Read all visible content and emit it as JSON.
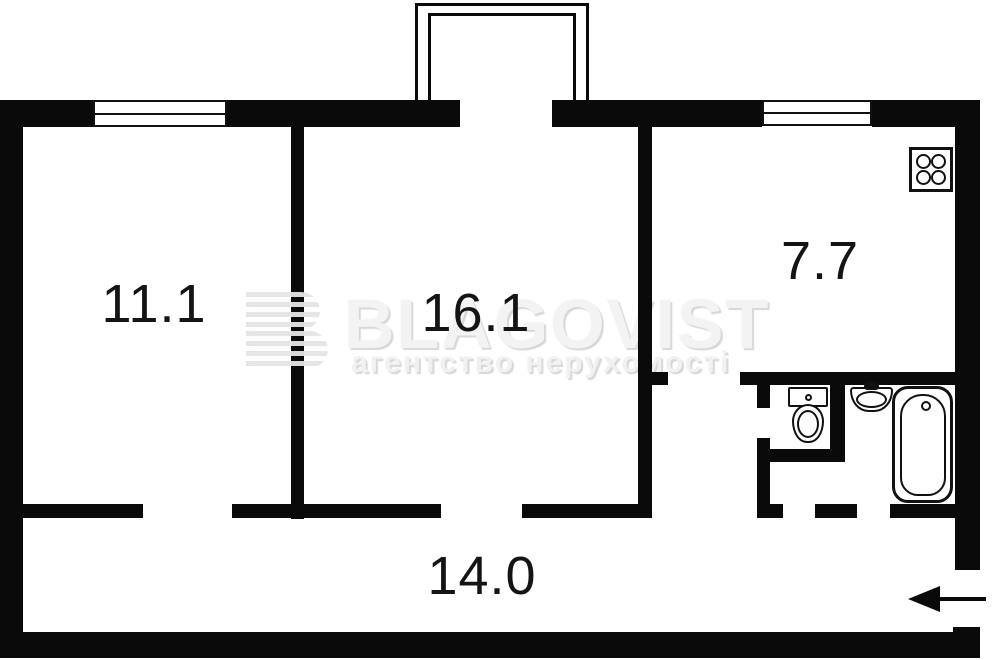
{
  "meta": {
    "document_type": "apartment floor plan",
    "language": "uk"
  },
  "colors": {
    "wall": "#0a0a0a",
    "background": "#ffffff",
    "fixture_outline": "#111111",
    "label_text": "#141414",
    "watermark_text": "#f3f3f3",
    "watermark_shadow": "#d7d7d7"
  },
  "rooms": [
    {
      "name": "room-left",
      "area_label": "11.1"
    },
    {
      "name": "room-center",
      "area_label": "16.1"
    },
    {
      "name": "kitchen",
      "area_label": "7.7"
    },
    {
      "name": "hallway",
      "area_label": "14.0"
    }
  ],
  "watermark": {
    "brand": "BLAGOVIST",
    "tagline": "агентство нерухомості"
  },
  "fixtures": [
    "balcony",
    "window-room-left",
    "window-kitchen",
    "stove",
    "toilet",
    "sink",
    "bathtub",
    "entrance-arrow"
  ]
}
